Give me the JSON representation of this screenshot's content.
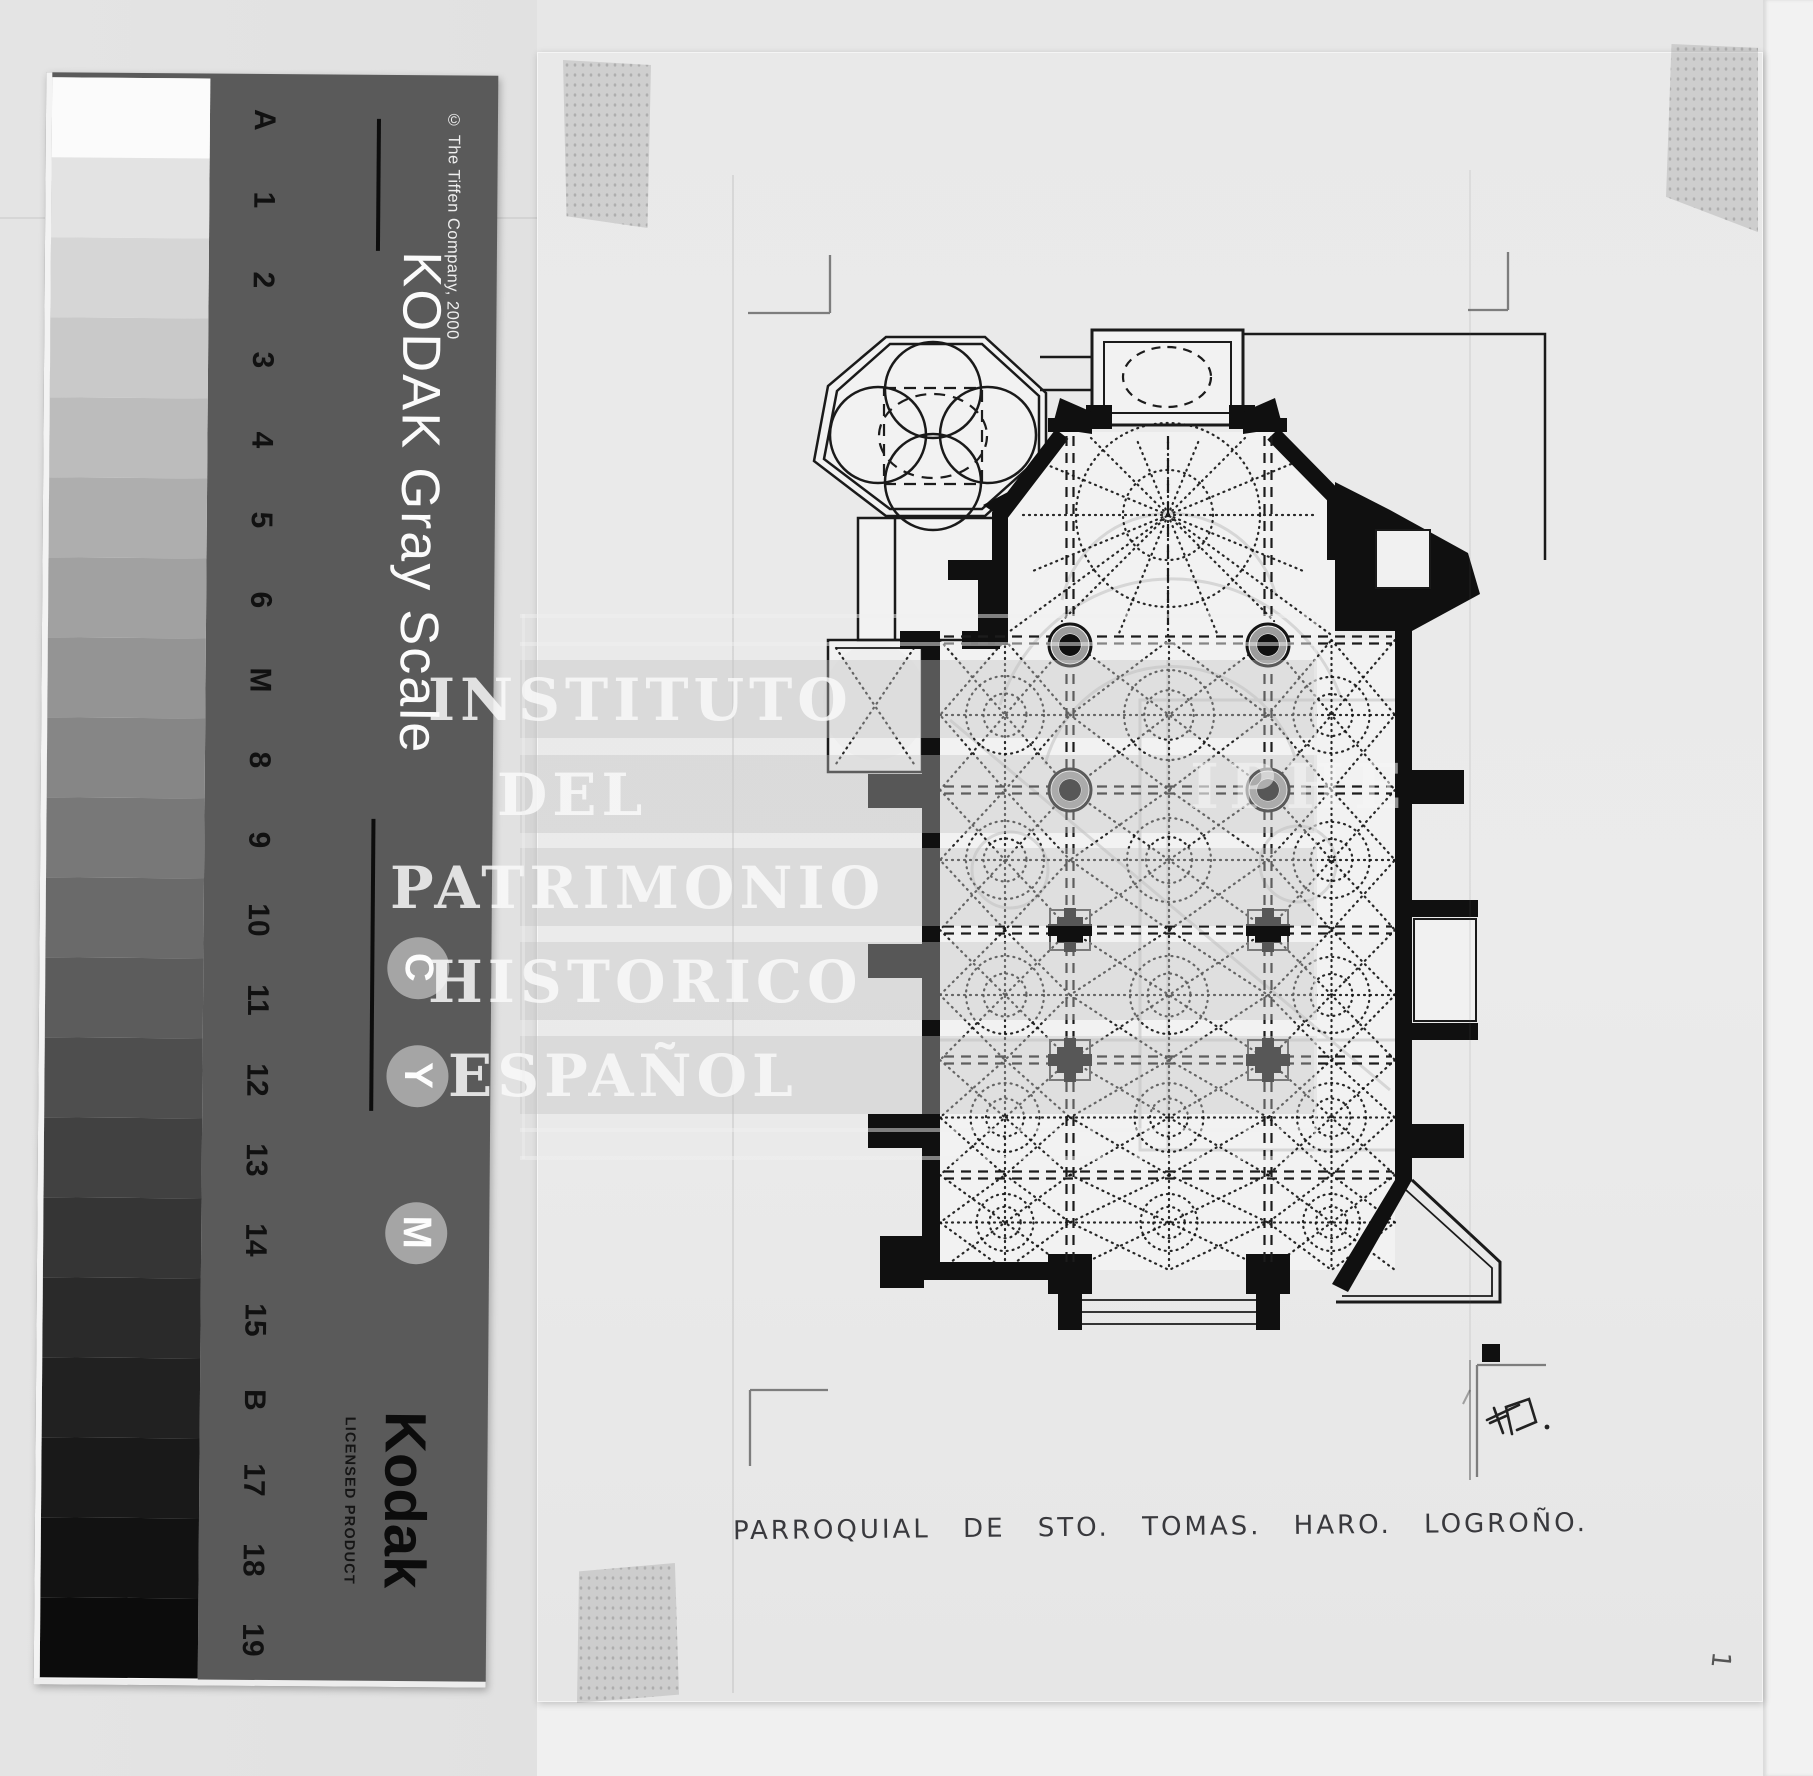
{
  "kodak": {
    "title": "KODAK Gray Scale",
    "copyright": "© The Tiffen Company, 2000",
    "brand": "Kodak",
    "licensed": "LICENSED PRODUCT",
    "scale_labels": [
      "A",
      "1",
      "2",
      "3",
      "4",
      "5",
      "6",
      "M",
      "8",
      "9",
      "10",
      "11",
      "12",
      "13",
      "14",
      "15",
      "B",
      "17",
      "18",
      "19"
    ],
    "patch_colors": [
      "#fbfbfb",
      "#e3e3e3",
      "#d6d6d6",
      "#c9c9c9",
      "#bcbcbc",
      "#aeaeae",
      "#a1a1a1",
      "#949494",
      "#868686",
      "#787878",
      "#6a6a6a",
      "#5c5c5c",
      "#4e4e4e",
      "#414141",
      "#353535",
      "#2a2a2a",
      "#212121",
      "#191919",
      "#121212",
      "#0c0c0c"
    ],
    "cym_circles": [
      "C",
      "Y",
      "M"
    ],
    "panel_color": "#5a5a5a"
  },
  "watermark": {
    "lines": [
      "INSTITUTO",
      "DEL",
      "PATRIMONIO",
      "HISTORICO",
      "ESPAÑOL"
    ],
    "monogram": "IPHE"
  },
  "drawing": {
    "caption": "PARROQUIAL DE STO. TOMAS. HARO. LOGROÑO.",
    "signature": "F.B.",
    "sheet_number": "1",
    "ink_color": "#141414",
    "sheet_color": "#e9e9e9"
  }
}
